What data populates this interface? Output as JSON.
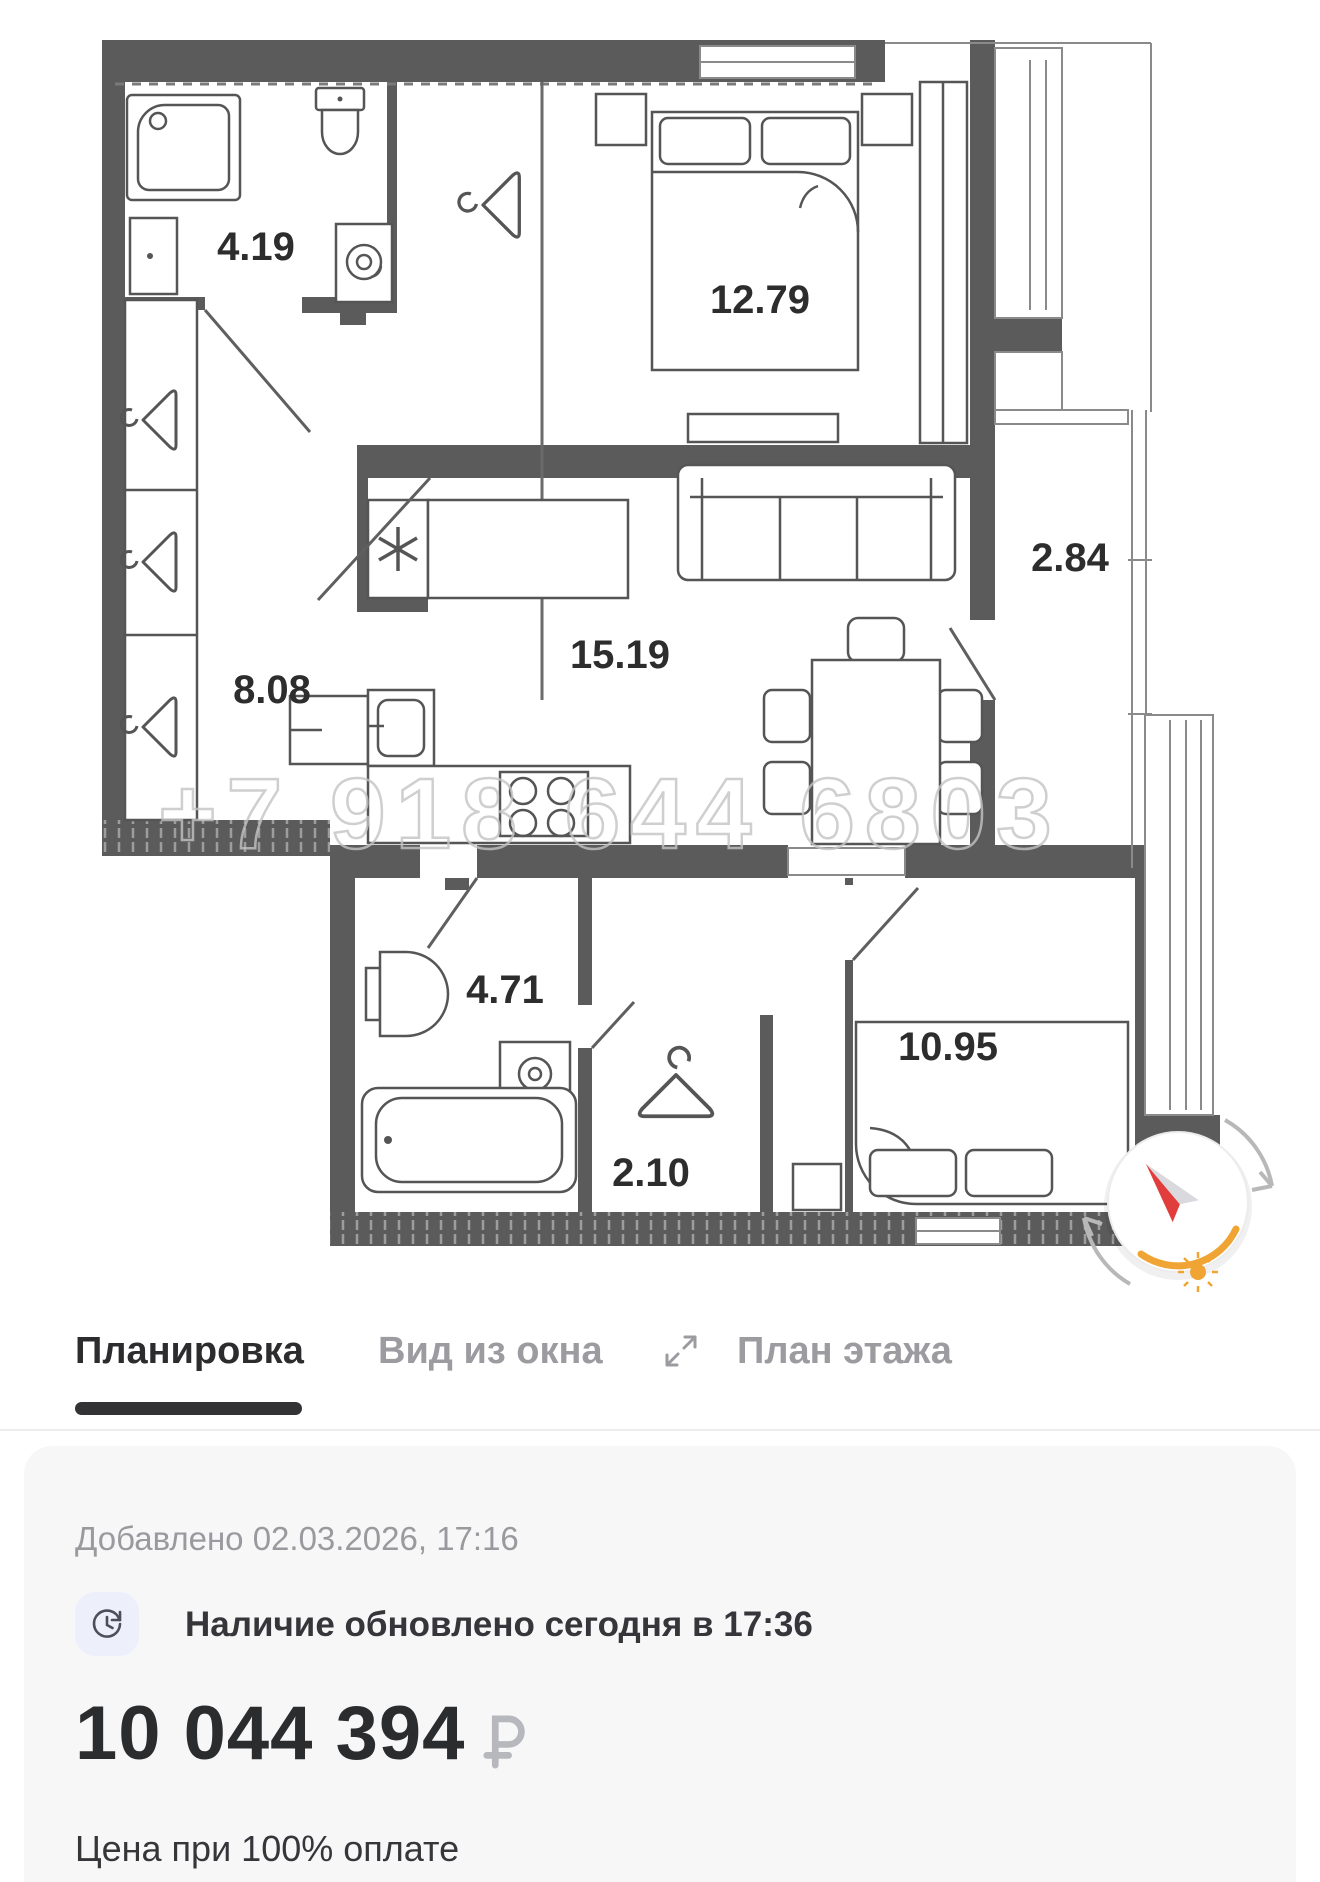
{
  "floor_plan": {
    "watermark": "+7 918 644 6803",
    "rooms": [
      {
        "id": "bathroom-top",
        "area": "4.19"
      },
      {
        "id": "bedroom-main",
        "area": "12.79"
      },
      {
        "id": "hallway",
        "area": "8.08"
      },
      {
        "id": "kitchen-living",
        "area": "15.19"
      },
      {
        "id": "balcony",
        "area": "2.84"
      },
      {
        "id": "bathroom-bottom",
        "area": "4.71"
      },
      {
        "id": "wardrobe-210",
        "area": "2.10"
      },
      {
        "id": "bedroom-second",
        "area": "10.95"
      }
    ],
    "icons": [
      "shower",
      "toilet",
      "sink",
      "washing-machine",
      "hanger",
      "stove-burners",
      "sofa",
      "bed",
      "dining-table",
      "bathtub",
      "compass",
      "sun"
    ]
  },
  "tabs": {
    "items": [
      {
        "label": "Планировка",
        "active": true
      },
      {
        "label": "Вид из окна",
        "active": false
      },
      {
        "label": "План этажа",
        "active": false
      }
    ]
  },
  "listing": {
    "added": "Добавлено 02.03.2026, 17:16",
    "availability": "Наличие обновлено сегодня в 17:36",
    "price": "10 044 394",
    "currency_symbol": "₽",
    "price_note": "Цена при 100% оплате"
  },
  "colors": {
    "wall": "#5b5b5b",
    "accent_orange": "#f0a433",
    "needle_red": "#e23d3d",
    "tab_active": "#2c2c2e",
    "tab_inactive": "#9b9ba0",
    "card_bg": "#f7f7f8",
    "watermark_gray": "#c4c4c4"
  }
}
